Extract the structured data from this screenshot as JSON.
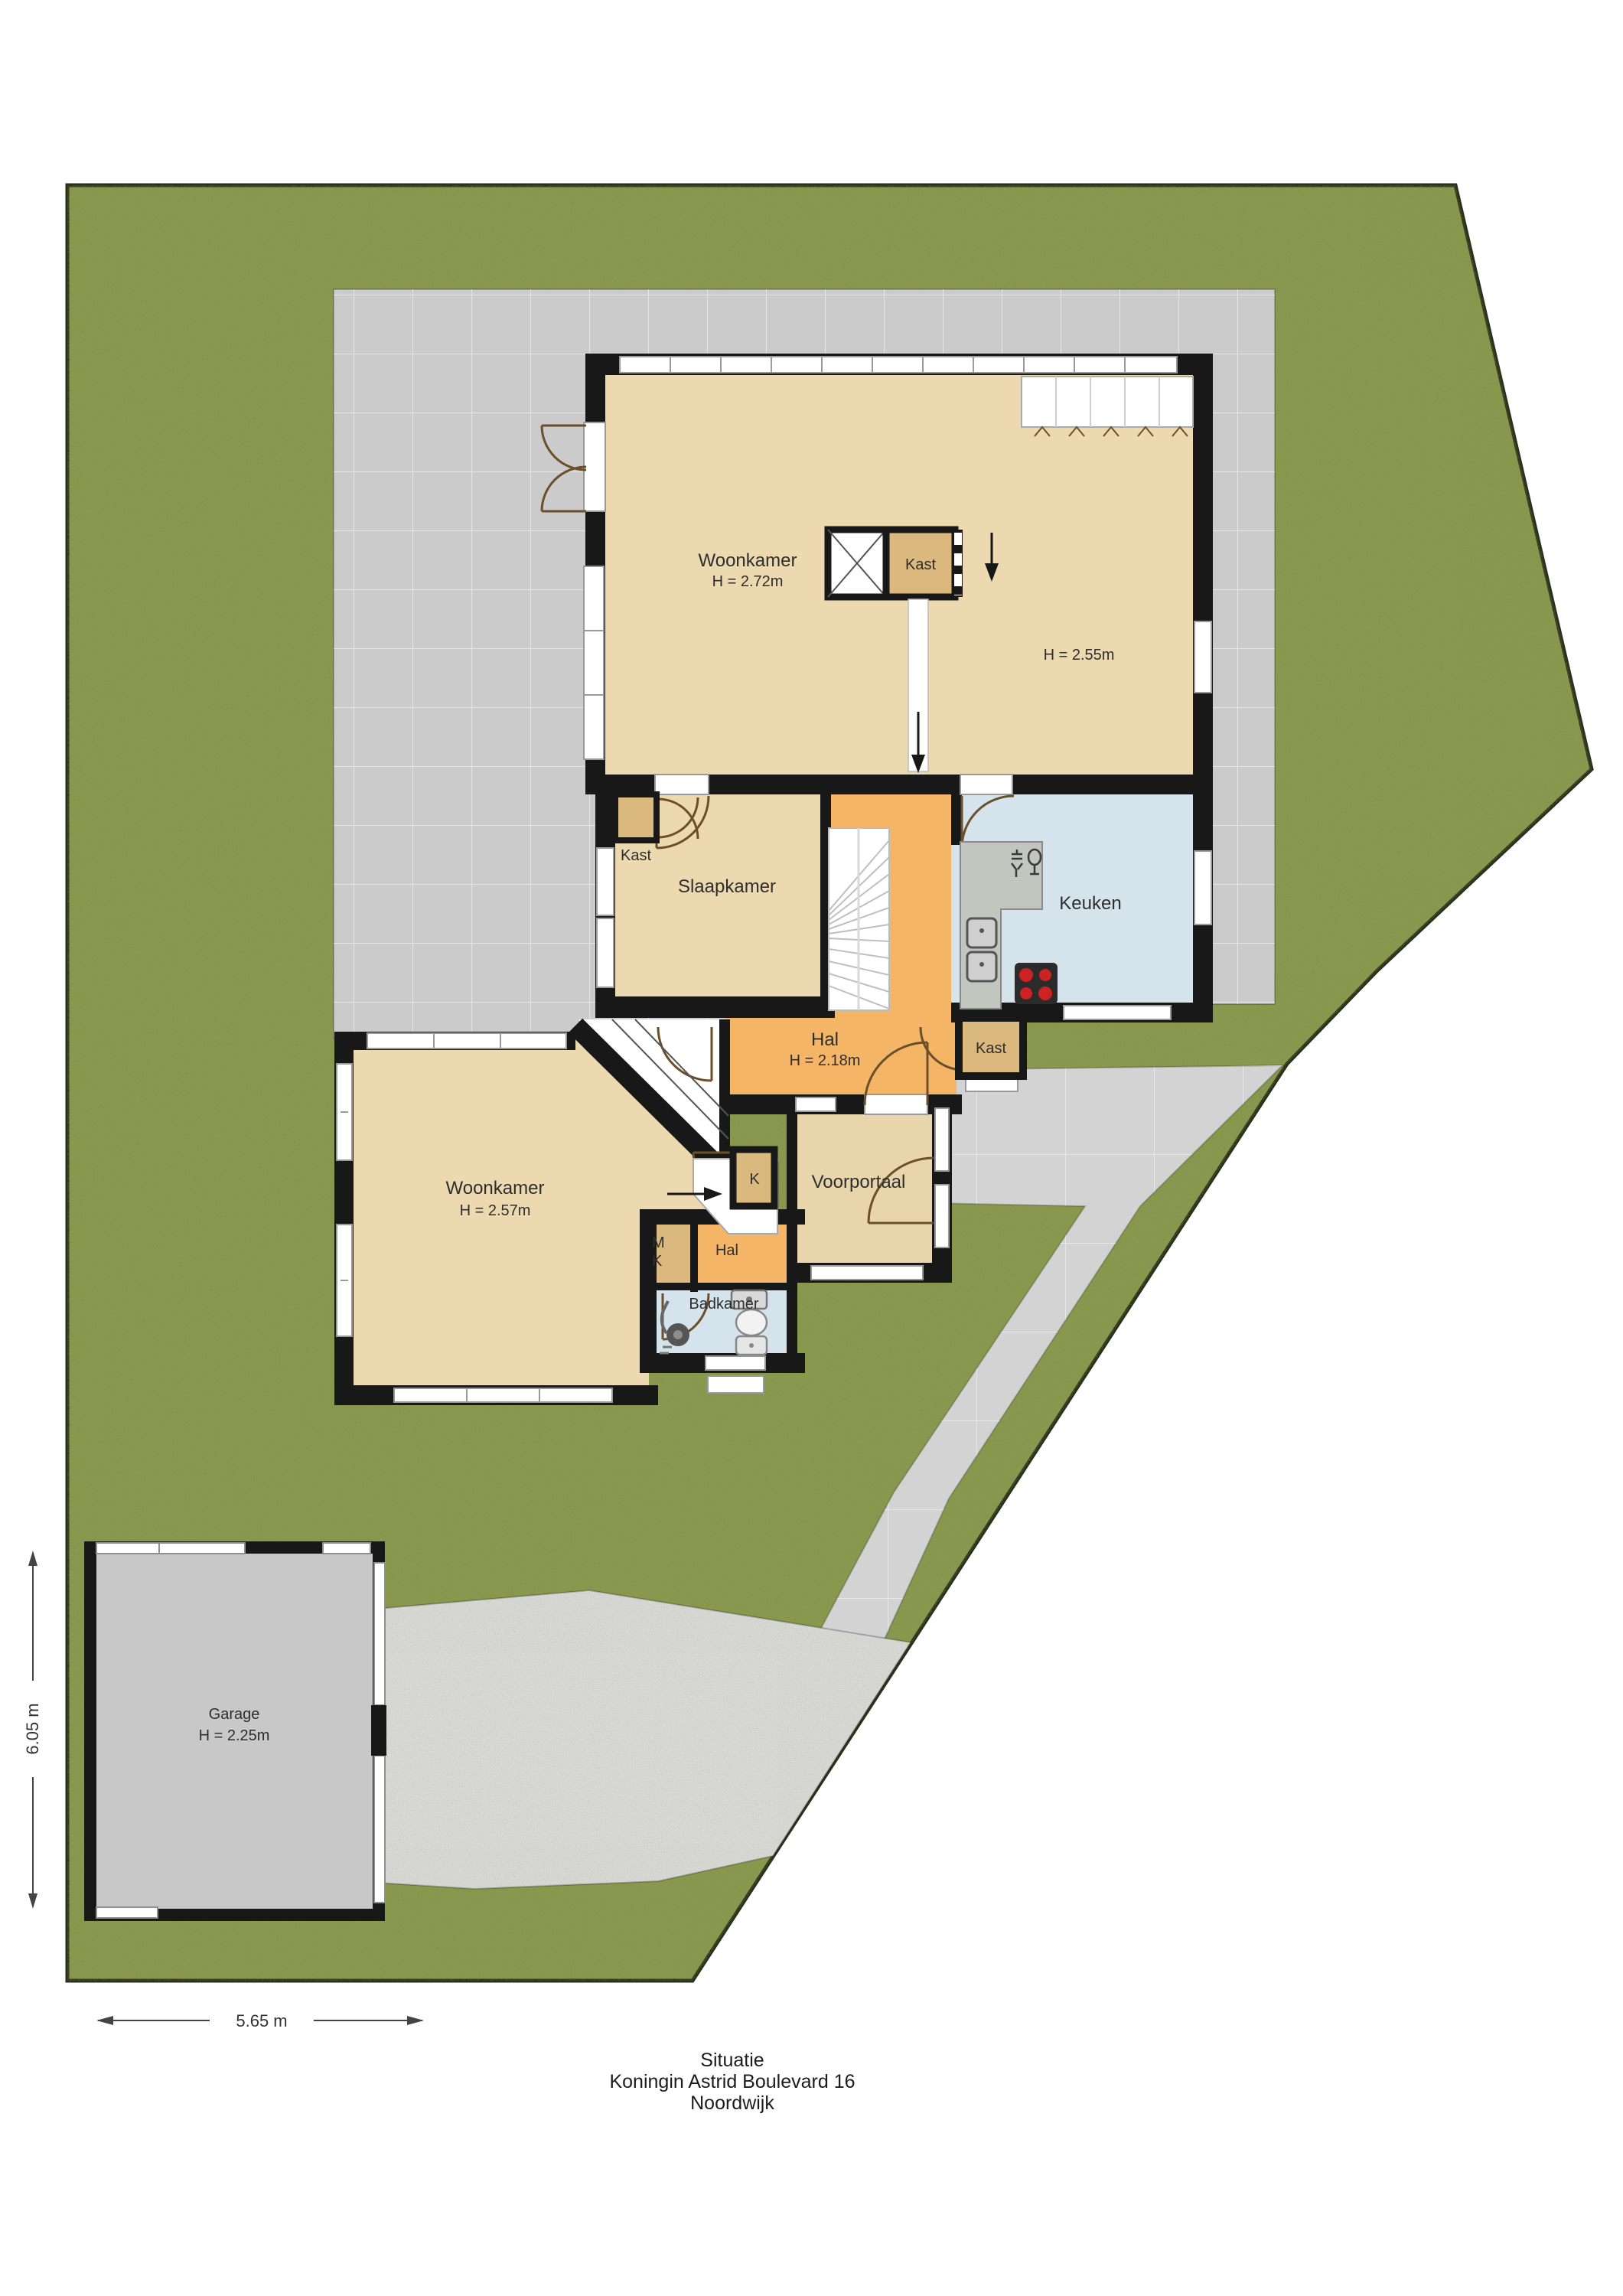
{
  "title": {
    "line1": "Situatie",
    "line2": "Koningin Astrid Boulevard 16",
    "line3": "Noordwijk"
  },
  "dimensions": {
    "plot_left_height": "6.05 m",
    "plot_bottom_width": "5.65 m"
  },
  "rooms": {
    "woonkamer_noord": {
      "label": "Woonkamer",
      "height": "H = 2.72m"
    },
    "kast_noord": {
      "label": "Kast"
    },
    "kamer_oost": {
      "height": "H = 2.55m"
    },
    "slaapkamer": {
      "label": "Slaapkamer"
    },
    "kast_midden": {
      "label": "Kast"
    },
    "keuken": {
      "label": "Keuken"
    },
    "hal_centraal": {
      "label": "Hal",
      "height": "H = 2.18m"
    },
    "kast_zuid": {
      "label": "Kast"
    },
    "woonkamer_zuid": {
      "label": "Woonkamer",
      "height": "H = 2.57m"
    },
    "k_kast": {
      "label": "K"
    },
    "meterkast": {
      "line1": "M",
      "line2": "K"
    },
    "hal_zuid": {
      "label": "Hal"
    },
    "voorportaal": {
      "label": "Voorportaal"
    },
    "badkamer": {
      "label": "Badkamer"
    },
    "garage": {
      "label": "Garage",
      "height": "H = 2.25m"
    }
  },
  "colors": {
    "grass": "#8B9A50",
    "paving": "#CBCBCB",
    "walkway": "#D3D3D3",
    "gravel": "#DCDCD8",
    "floor_tan": "#ECD9B0",
    "closet_tan": "#DBB97E",
    "hall_orange": "#F4B566",
    "wet_room_blue": "#D5E3ED",
    "wall_black": "#181818",
    "garage_floor": "#C8C8C8"
  }
}
